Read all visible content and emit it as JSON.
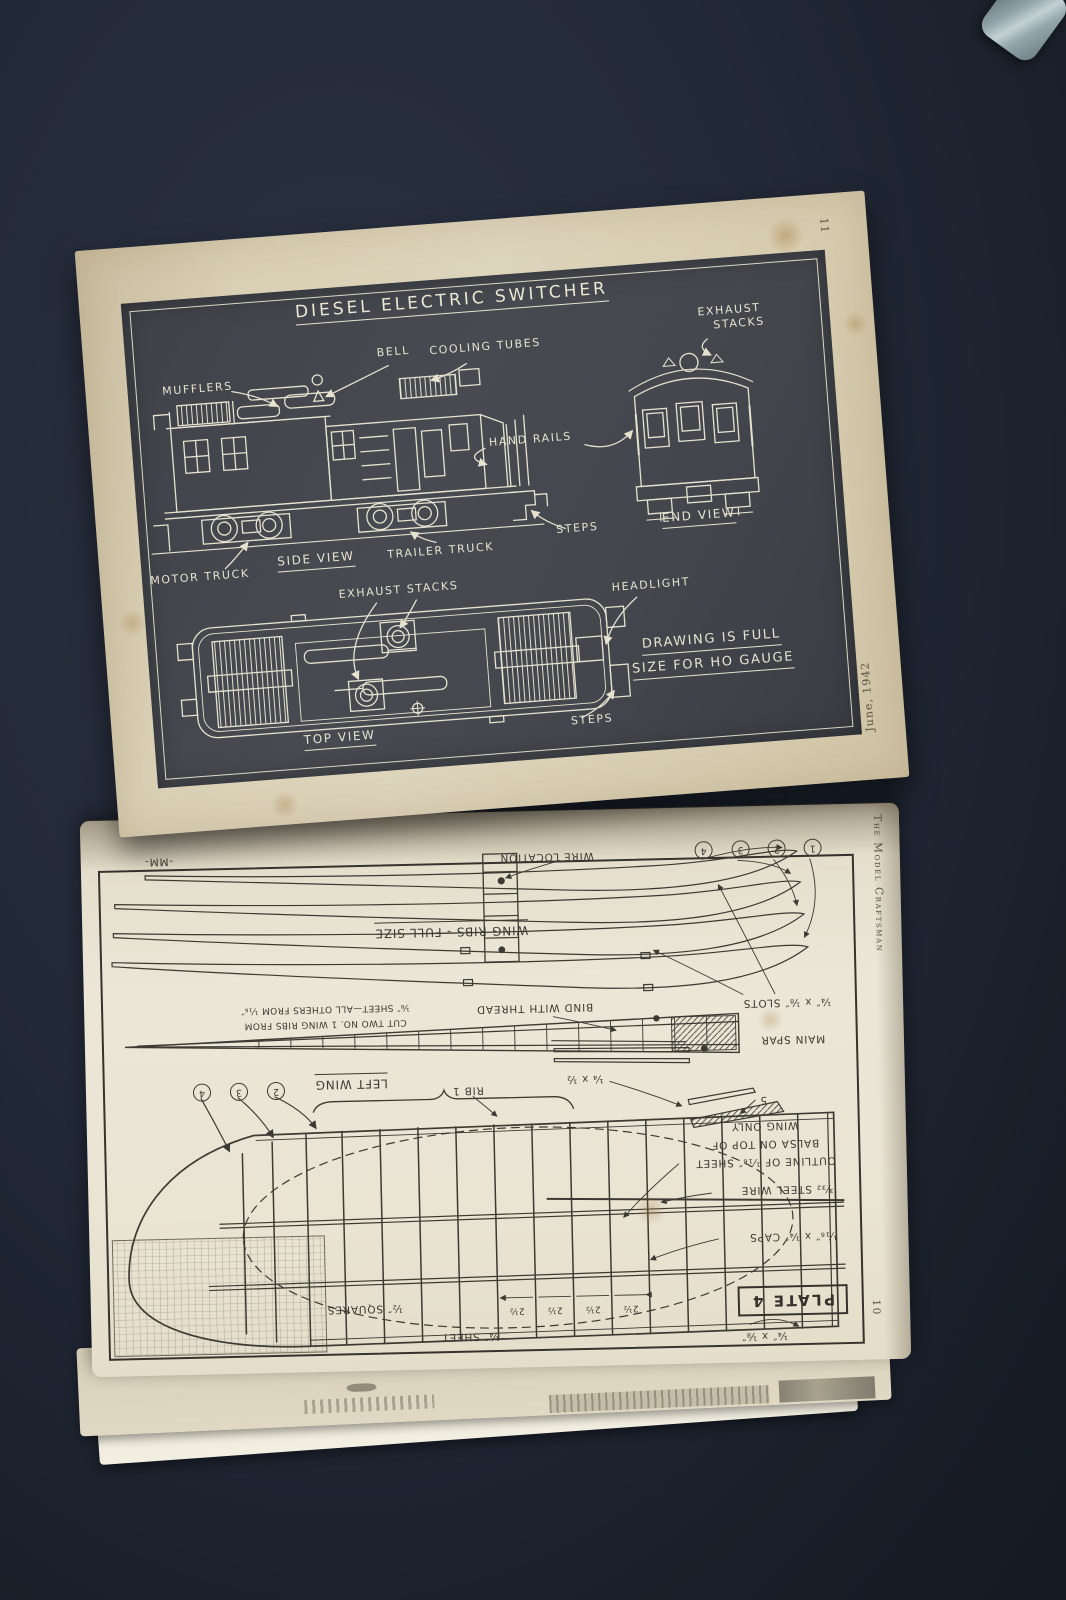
{
  "magazine": {
    "running_head": "The Model Craftsman",
    "issue_date": "June, 1942"
  },
  "top_page": {
    "page_number": "11",
    "plate": {
      "title": "DIESEL ELECTRIC SWITCHER",
      "labels": {
        "mufflers": "MUFFLERS",
        "bell": "BELL",
        "cooling_tubes": "COOLING TUBES",
        "exhaust_stacks_line1": "EXHAUST",
        "exhaust_stacks_line2": "STACKS",
        "hand_rails": "HAND RAILS",
        "motor_truck": "MOTOR TRUCK",
        "side_view": "SIDE VIEW",
        "trailer_truck": "TRAILER TRUCK",
        "steps": "STEPS",
        "end_view": "END VIEW",
        "exhaust_stacks_mid": "EXHAUST STACKS",
        "headlight": "HEADLIGHT",
        "top_view": "TOP VIEW",
        "note_line1": "DRAWING IS FULL",
        "note_line2": "SIZE FOR HO GAUGE"
      }
    }
  },
  "bottom_page": {
    "page_number": "10",
    "plate_label": "PLATE 4",
    "labels": {
      "mm": "-MM-",
      "wire_location": "WIRE LOCATION",
      "wing_ribs_full_size": "WING RIBS - FULL SIZE",
      "cut_note_line1": "CUT TWO NO. 1 WING RIBS FROM",
      "cut_note_line2": "⅛″ SHEET—ALL OTHERS FROM ¹⁄₁₆″",
      "bind_with_thread": "BIND WITH THREAD",
      "slots": "¼″ x ⅛″ SLOTS",
      "main_spar": "MAIN SPAR",
      "stock_quarter_half": "¼ x ½",
      "dim_five": "5",
      "left_wing": "LEFT WING",
      "rib_one": "RIB 1",
      "outline_line1": "OUTLINE OF ¹⁄₁₆″ SHEET",
      "outline_line2": "BALSA ON TOP OF",
      "outline_line3": "WING ONLY",
      "steel_wire": "³⁄₃₂ STEEL WIRE",
      "caps": "¹⁄₁₆″ x ¼″ CAPS",
      "rib_spacing": "2½",
      "half_squares": "½″ SQUARES",
      "quarter_sheet": "¼″ SHEET",
      "quarter_eighth": "¼″ x ⅛″"
    },
    "rib_numbers": [
      "1",
      "2",
      "3",
      "4"
    ],
    "plan_rib_numbers": [
      "2",
      "3",
      "4"
    ]
  }
}
